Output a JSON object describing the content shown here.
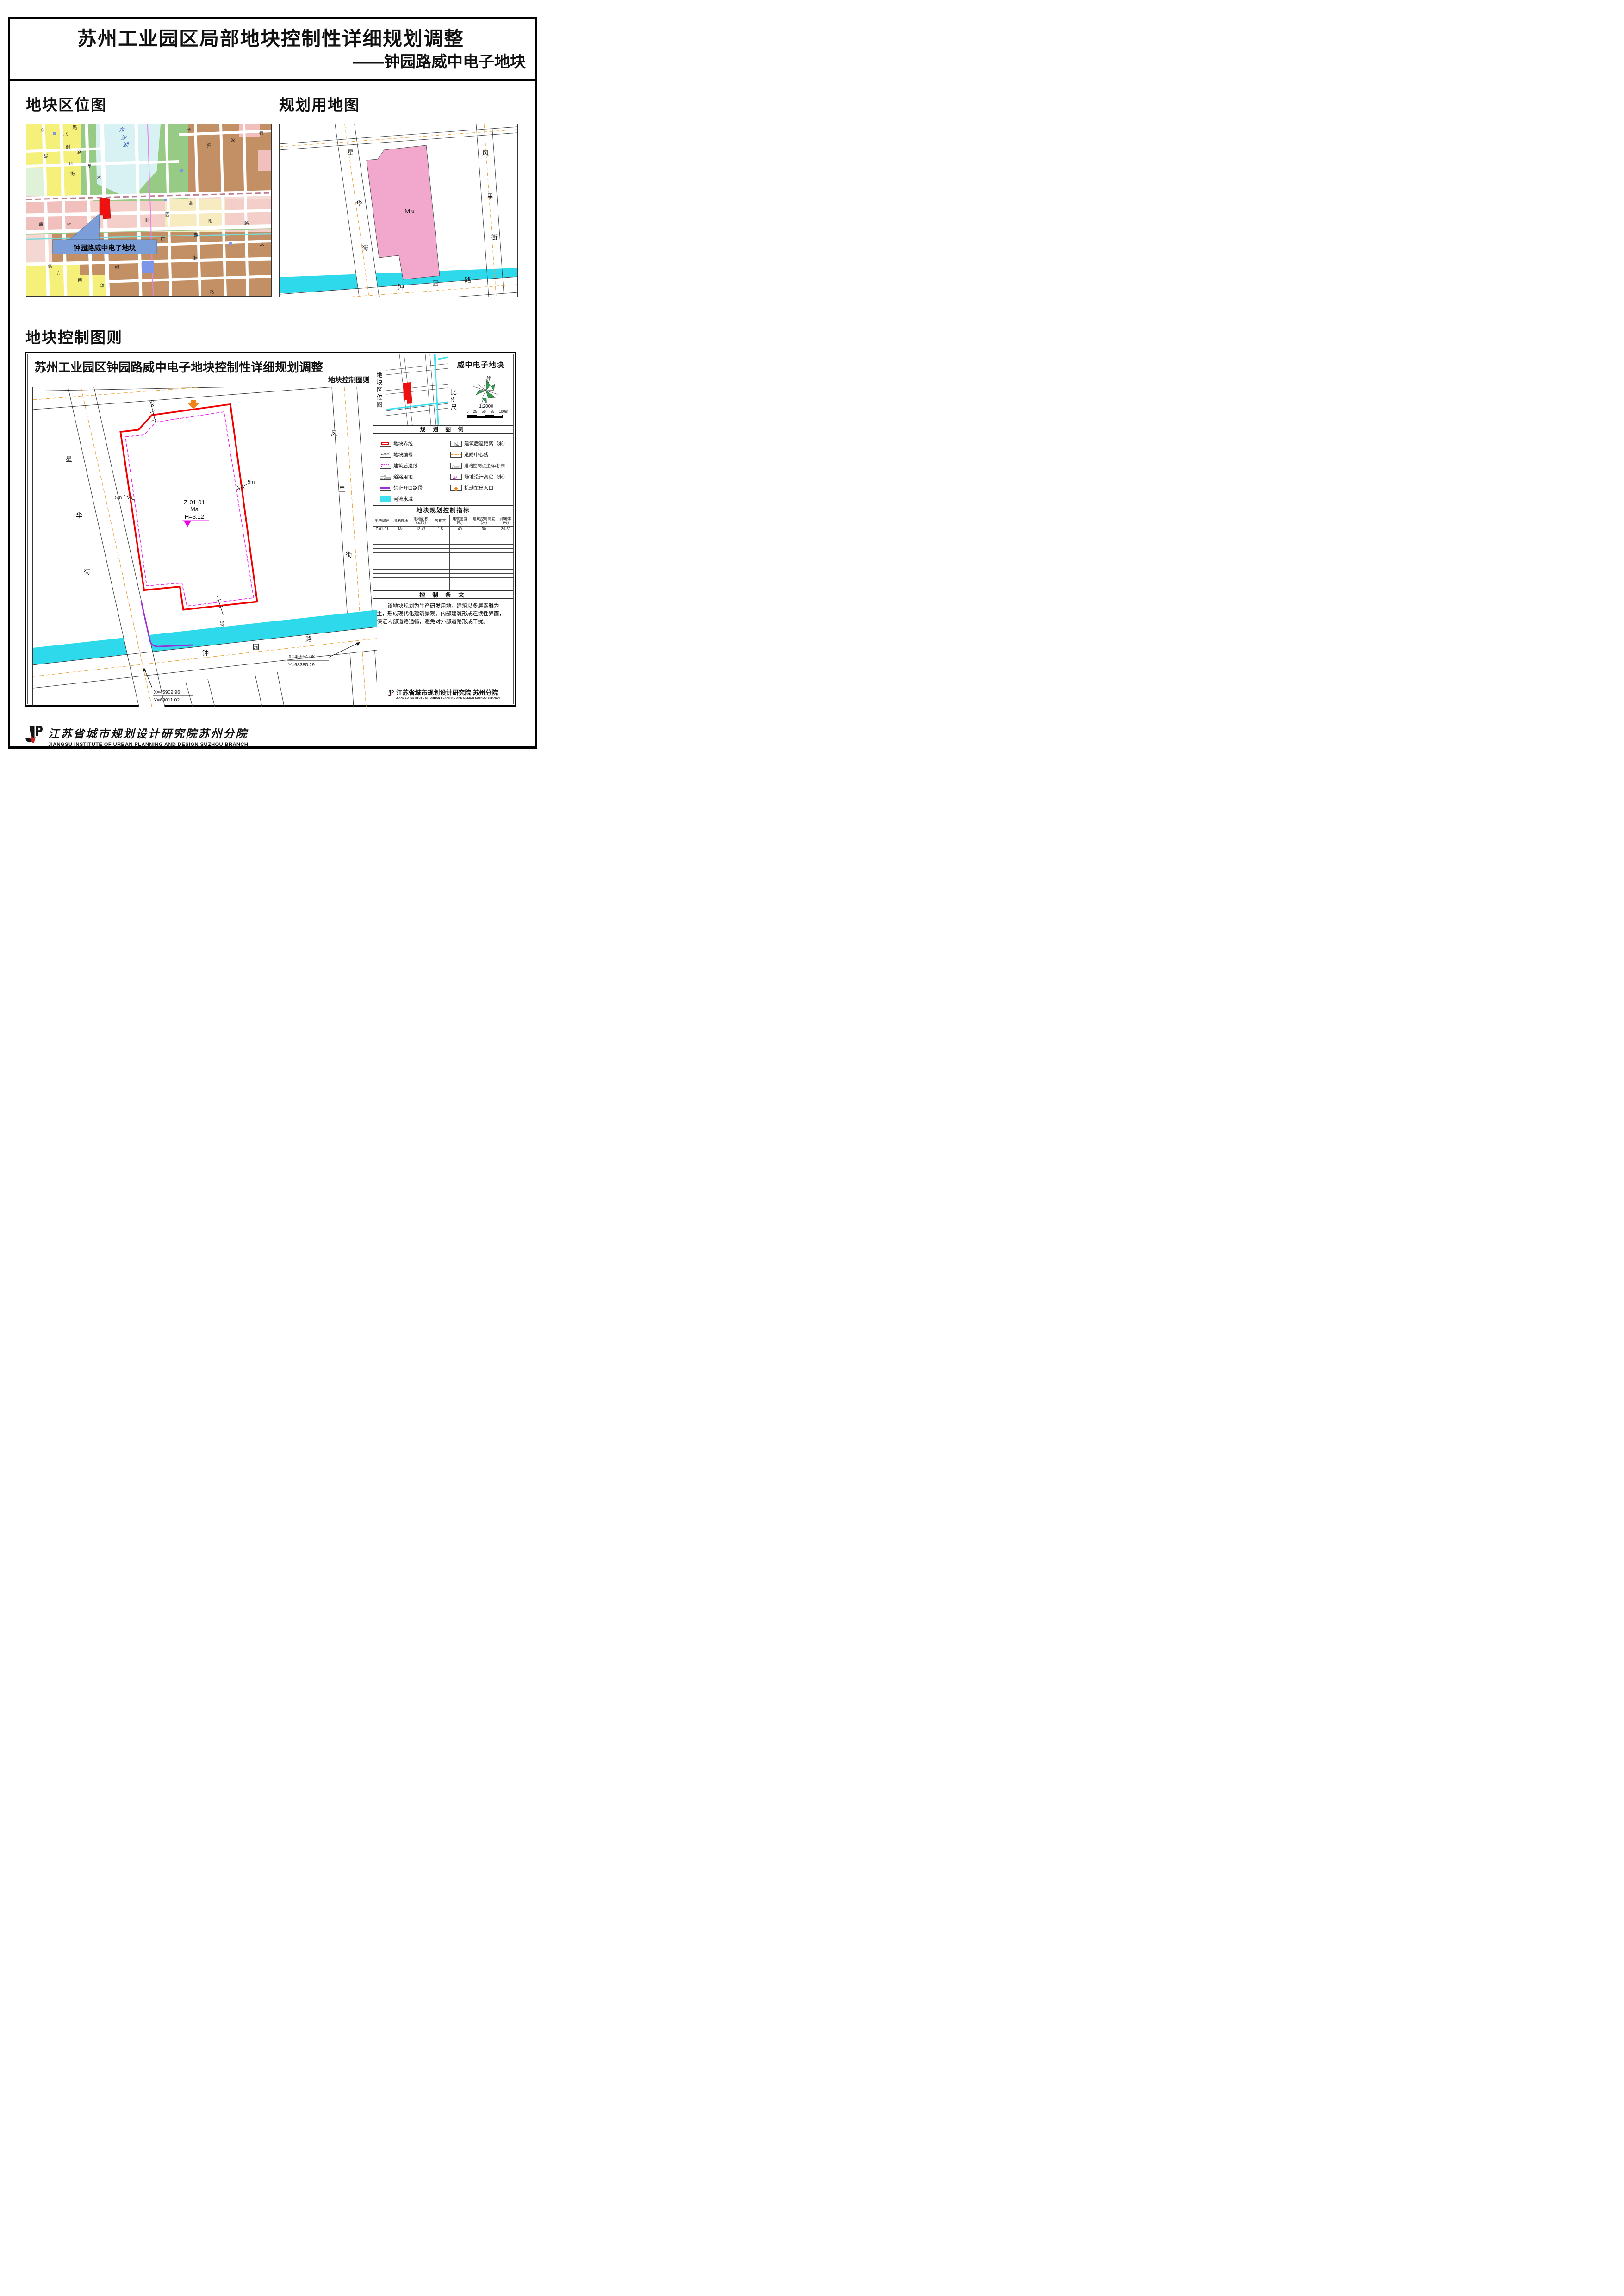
{
  "page": {
    "title_line1": "苏州工业园区局部地块控制性详细规划调整",
    "title_line2": "——钟园路威中电子地块"
  },
  "colors": {
    "plot_boundary": "#EE0000",
    "setback_line": "#EE22EE",
    "river": "#2FD9EC",
    "no_opening_segment": "#9B2FD6",
    "road_centerline": "#E8A33D",
    "entrance_arrow": "#F08418",
    "landuse_ma_fill": "#F2A8CC",
    "callout_bg": "#7B9ED9"
  },
  "location_map": {
    "heading": "地块区位图",
    "callout": "钟园路威中电子地块",
    "lake_chars": [
      "东",
      "沙",
      "湖"
    ],
    "labels": [
      "东",
      "路",
      "北",
      "谢",
      "湖",
      "路",
      "雨",
      "街",
      "星",
      "大",
      "道",
      "长",
      "归",
      "家",
      "巷",
      "锦",
      "钟",
      "里",
      "园",
      "阳",
      "路",
      "龙",
      "庄",
      "路",
      "街",
      "溪",
      "方",
      "南",
      "华",
      "洲",
      "路"
    ]
  },
  "landuse_map": {
    "heading": "规划用地图",
    "plot_code": "Ma",
    "west_street": [
      "星",
      "华",
      "街"
    ],
    "east_street": [
      "风",
      "里",
      "街"
    ],
    "south_road": [
      "钟",
      "园",
      "路"
    ]
  },
  "control": {
    "heading": "地块控制图则",
    "title": "苏州工业园区钟园路威中电子地块控制性详细规划调整",
    "subtitle": "地块控制图则",
    "plot_title": "威中电子地块",
    "mini_map_label": "地块区位图",
    "scale_label": "比例尺",
    "north": "N",
    "scale": "1:2000",
    "scale_ticks": [
      "0",
      "25",
      "50",
      "75",
      "100m"
    ],
    "drawing": {
      "plot_code": "Z-01-01",
      "plot_use": "Ma",
      "elevation": "H=3.12",
      "setback": "5m",
      "west_street": [
        "星",
        "华",
        "街"
      ],
      "east_street": [
        "风",
        "里",
        "街"
      ],
      "south_road": [
        "钟",
        "园",
        "路"
      ],
      "coord1_x": "X=45909.96",
      "coord1_y": "Y=68011.02",
      "coord2_x": "X=45954.08",
      "coord2_y": "Y=68385.29"
    },
    "legend": {
      "header": "规 划 图 例",
      "items_left": [
        "地块界线",
        "地块编号",
        "建筑后退线",
        "道路用地",
        "禁止开口路段",
        "河流水域"
      ],
      "items_right": [
        "建筑后退距离（米）",
        "道路中心线",
        "道路控制点坐标/标高",
        "场地设计高程（米）",
        "机动车出入口"
      ],
      "plot_number_sample": "A-01-01",
      "setback_sample": "5",
      "elevation_sample": "H=3.0"
    },
    "indicators": {
      "header": "地块规划控制指标",
      "columns_l1": [
        "地块编码",
        "用地性质",
        "用地面积",
        "容积率",
        "建筑密度",
        "建筑控制高度",
        "绿地率"
      ],
      "columns_l2": [
        "",
        "",
        "(公顷)",
        "",
        "(%)",
        "(米)",
        "(%)"
      ],
      "row": [
        "Z-01-01",
        "Ma",
        "13.47",
        "1.5",
        "40",
        "30",
        "30-50"
      ]
    },
    "clauses": {
      "header": "控 制 条 文",
      "text": "该地块规划为生产研发用地，建筑以多层素雅为主，形成现代化建筑景观。内部建筑形成连续性界面，保证内部道路通畅，避免对外部道路形成干扰。"
    },
    "stamp": {
      "cn": "江苏省城市规划设计研究院 苏州分院",
      "en": "JIANGSU INSTITUTE OF URBAN PLANNING AND DESIGN  SUZHOU BRANCH"
    }
  },
  "footer": {
    "cn": "江苏省城市规划设计研究院苏州分院",
    "en": "JIANGSU INSTITUTE OF URBAN PLANNING AND DESIGN SUZHOU BRANCH"
  }
}
